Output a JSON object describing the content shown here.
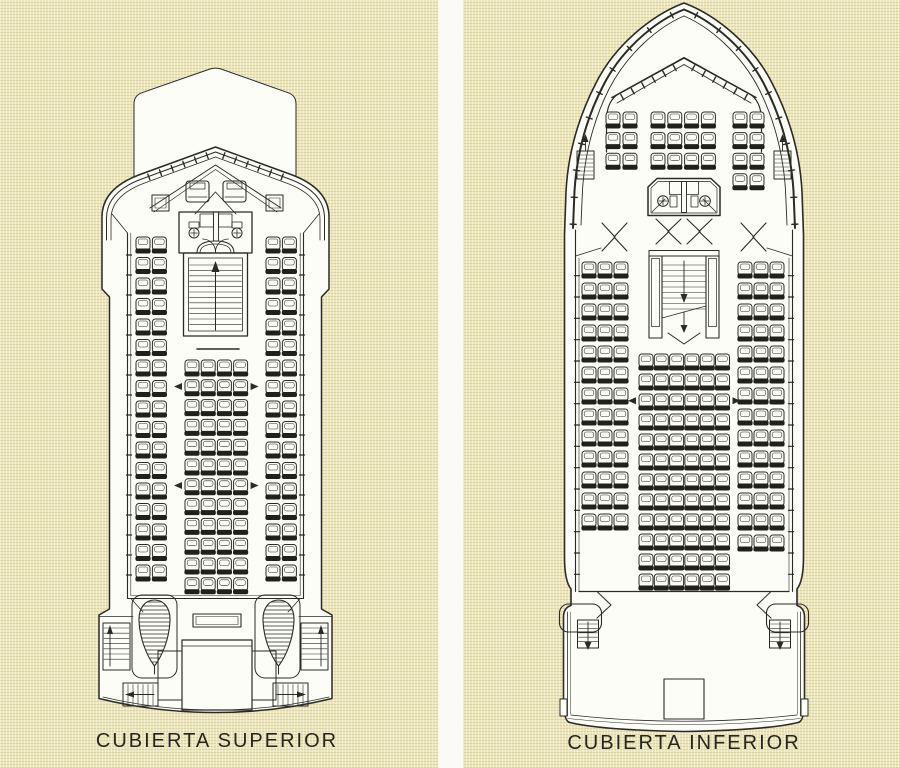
{
  "palette": {
    "panel_color": "#e8e1b2",
    "gutter_color": "#fbfaf4",
    "paper_white": "#fdfdf8",
    "line_color": "#2b2a26",
    "seat_back_color": "#21201c"
  },
  "plans": [
    {
      "id": "superior",
      "label": "CUBIERTA SUPERIOR",
      "label_x": 217,
      "label_y": 730,
      "seat_style": {
        "w": 14,
        "h": 16.5,
        "back_h": 5
      },
      "seat_groups": [
        {
          "name": "port-seat-rows",
          "x": 136,
          "y": 237,
          "cols": 2,
          "rows": 17,
          "dx": 16.4,
          "dy": 20.5
        },
        {
          "name": "starboard-seat-rows",
          "x": 266,
          "y": 237,
          "cols": 2,
          "rows": 17,
          "dx": 16.4,
          "dy": 20.5
        },
        {
          "name": "center-seat-block",
          "x": 185,
          "y": 360,
          "cols": 4,
          "rows": 12,
          "dx": 16.2,
          "dy": 19.8,
          "arrow_rows": [
            1,
            6
          ]
        }
      ]
    },
    {
      "id": "inferior",
      "label": "CUBIERTA INFERIOR",
      "label_x": 684,
      "label_y": 732,
      "seat_style": {
        "w": 14,
        "h": 16.5,
        "back_h": 5
      },
      "seat_groups": [
        {
          "name": "bow-port-seats",
          "x": 606,
          "y": 112,
          "cols": 2,
          "rows": 3,
          "dx": 17,
          "dy": 20.6
        },
        {
          "name": "bow-center-seats",
          "x": 651,
          "y": 112,
          "cols": 4,
          "rows": 3,
          "dx": 16.8,
          "dy": 20.6
        },
        {
          "name": "bow-starboard-seats",
          "x": 733,
          "y": 112,
          "cols": 2,
          "rows": 4,
          "dx": 17,
          "dy": 20.6
        },
        {
          "name": "main-port-seats",
          "x": 582,
          "y": 262,
          "cols": 3,
          "rows": 13,
          "dx": 16,
          "dy": 21
        },
        {
          "name": "main-starboard-seats",
          "x": 738,
          "y": 262,
          "cols": 3,
          "rows": 14,
          "dx": 16,
          "dy": 21
        },
        {
          "name": "main-center-seats",
          "x": 639,
          "y": 354,
          "cols": 6,
          "rows": 12,
          "dx": 15.3,
          "dy": 20,
          "arrow_rows": [
            2
          ]
        }
      ]
    }
  ]
}
